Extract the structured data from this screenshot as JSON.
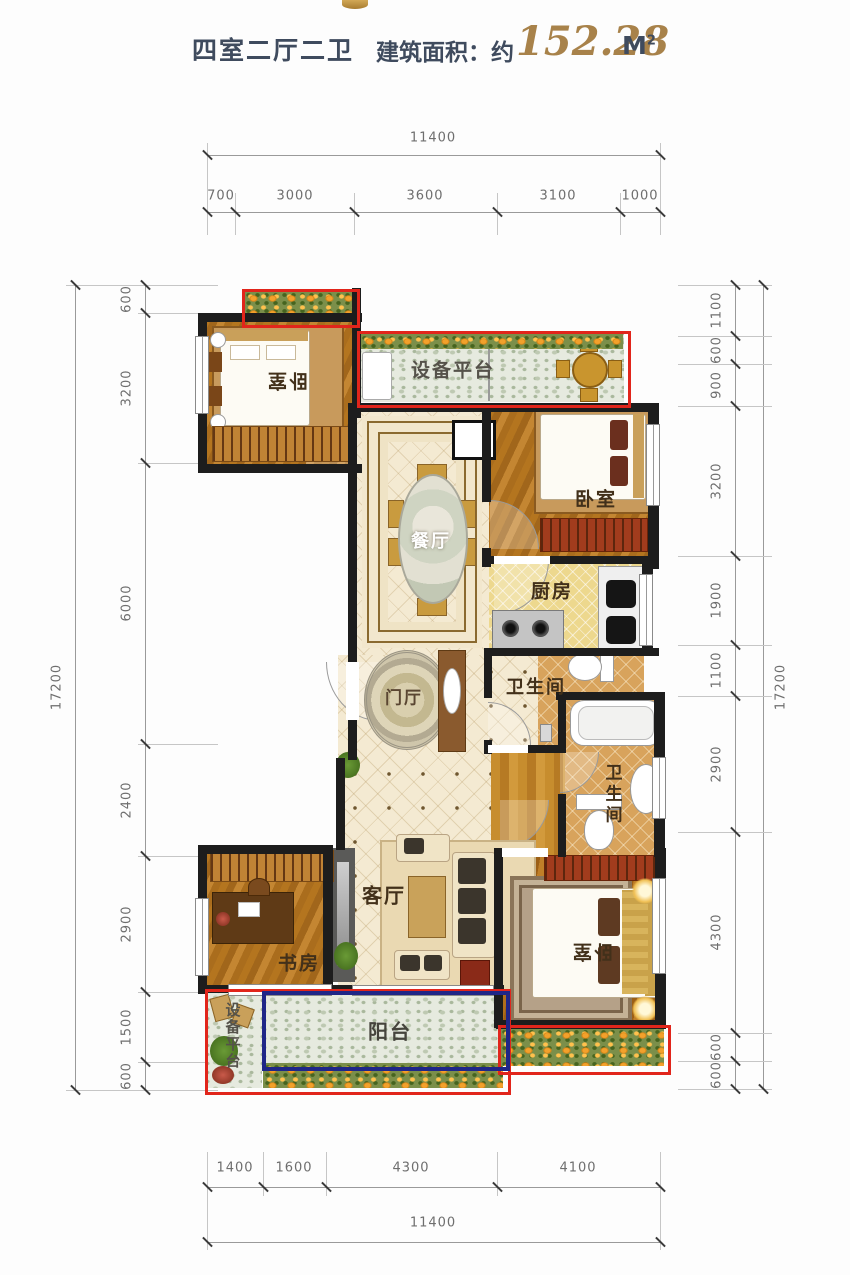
{
  "header": {
    "layout": "四室二厅二卫",
    "area_label": "建筑面积：约",
    "area_value": "152.28",
    "area_unit": "M",
    "area_unit_exp": "2"
  },
  "rooms": {
    "bedroom1": "卧室",
    "bedroom2": "卧室",
    "bedroom3": "卧室",
    "dining": "餐厅",
    "living": "客厅",
    "kitchen": "厨房",
    "bath1": "卫生间",
    "bath2": "卫生间",
    "foyer": "门厅",
    "study": "书房",
    "balcony": "阳台",
    "equipment_top": "设备平台",
    "equipment_bottom": "设备平台"
  },
  "dimensions": {
    "top": {
      "total": "11400",
      "segments": [
        "700",
        "3000",
        "3600",
        "3100",
        "1000"
      ]
    },
    "bottom": {
      "total": "11400",
      "segments": [
        "1400",
        "1600",
        "4300",
        "4100"
      ]
    },
    "left": {
      "total": "17200",
      "segments": [
        "600",
        "3200",
        "6000",
        "2400",
        "2900",
        "1500",
        "600"
      ]
    },
    "right": {
      "total": "17200",
      "segments": [
        "1100",
        "600",
        "900",
        "3200",
        "1900",
        "1100",
        "2900",
        "4300",
        "600",
        "600"
      ]
    }
  },
  "colors": {
    "annotation_red": "#e1251b",
    "annotation_blue": "#1f2687",
    "area_gold": "#a8824a",
    "title_dark": "#3f4b5e"
  }
}
